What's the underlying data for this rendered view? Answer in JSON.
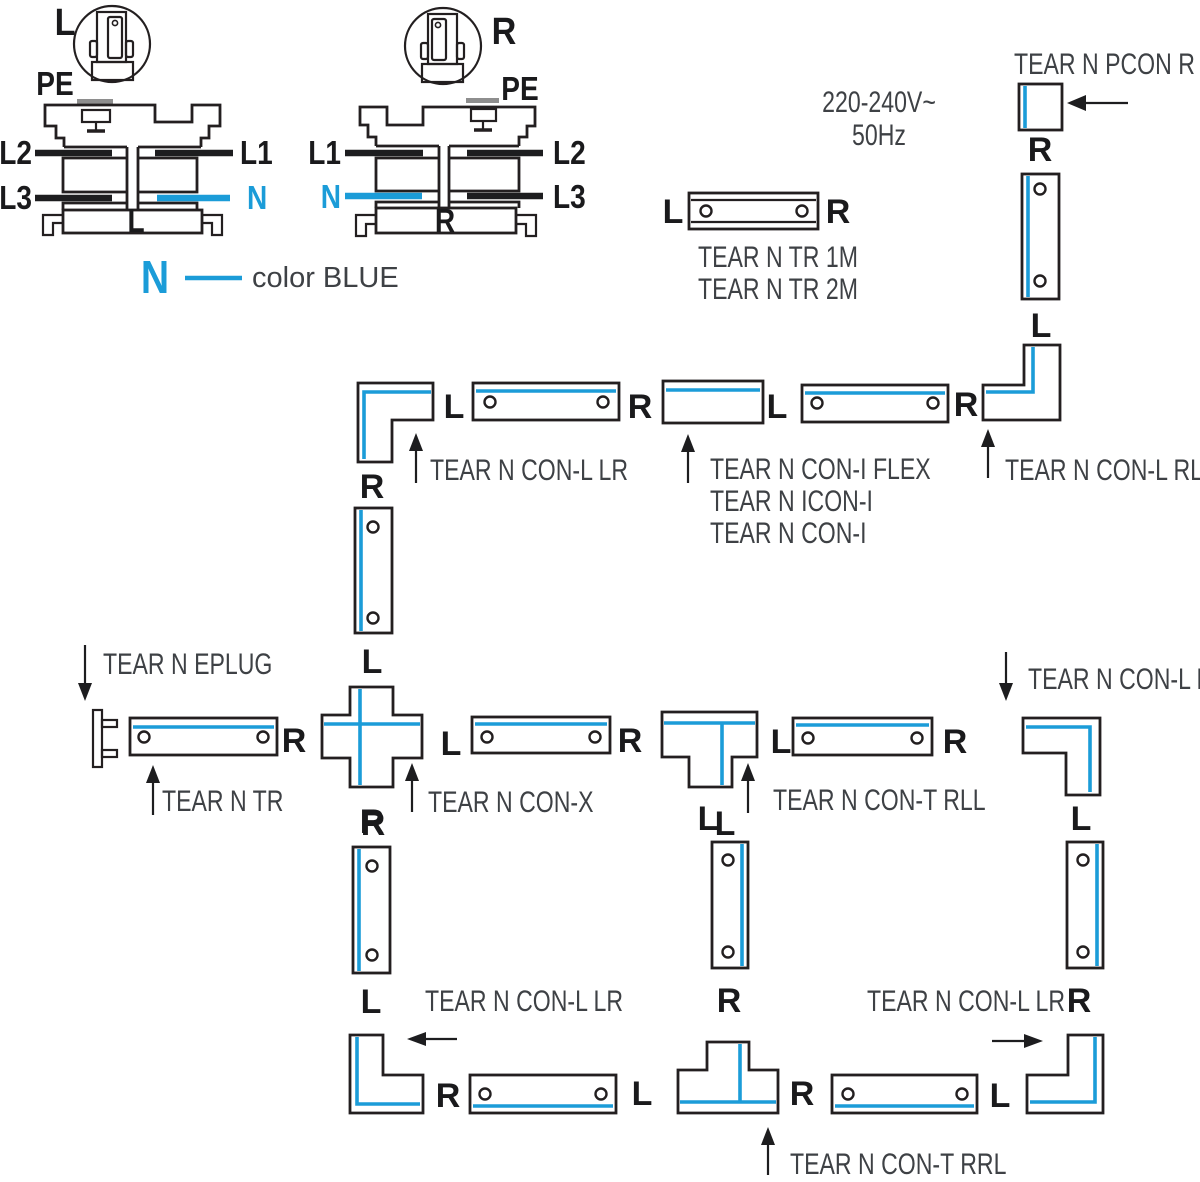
{
  "colors": {
    "blue": "#1B9CD8",
    "outline": "#231F20",
    "text": "#3E4145"
  },
  "cross_section_left": {
    "plug": "L",
    "pe": "PE",
    "top_left": "L2",
    "top_right": "L1",
    "bottom_left": "L3",
    "bottom_right": "N",
    "base": "L"
  },
  "cross_section_right": {
    "plug": "R",
    "pe": "PE",
    "top_left": "L1",
    "top_right": "L2",
    "bottom_left": "N",
    "bottom_right": "L3",
    "base": "R"
  },
  "legend": {
    "symbol": "N",
    "label": "color BLUE"
  },
  "power": {
    "voltage": "220-240V~",
    "frequency": "50Hz"
  },
  "products": {
    "pcon": "TEAR N PCON R",
    "tr_1m": "TEAR N TR 1M",
    "tr_2m": "TEAR N TR 2M",
    "con_l_lr_top": "TEAR N CON-L LR",
    "con_i_flex": "TEAR N CON-I FLEX",
    "icon_i": "TEAR N ICON-I",
    "con_i": "TEAR N CON-I",
    "con_l_rl": "TEAR N CON-L RL",
    "eplug": "TEAR N EPLUG",
    "con_l_lr_mid": "TEAR N CON-L LR",
    "tr": "TEAR N TR",
    "con_x": "TEAR N CON-X",
    "con_t_rll": "TEAR N CON-T RLL",
    "con_l_lr_bottom_left": "TEAR N CON-L LR",
    "con_l_lr_bottom_right": "TEAR N CON-L LR",
    "con_t_rrl": "TEAR N CON-T RRL"
  },
  "ports": {
    "tr_left": "L",
    "tr_right": "R",
    "pcon_out": "R",
    "feed_track_bottom": "L",
    "corner_tl_right": "L",
    "row1_track1_right": "R",
    "con_i_right": "L",
    "row1_track2_right": "R",
    "corner_tl_bottom": "R",
    "cross_top": "L",
    "cross_right": "L",
    "cross_bottom": "R",
    "eplug_track_right": "R",
    "row2_track1_right": "R",
    "t_rll_bottom": "L",
    "row2_track2_left": "L",
    "row2_track2_right": "R",
    "corner_mr_bottom": "L",
    "vleft_top": "R",
    "vleft_bottom": "L",
    "vmid_top": "L",
    "vmid_bottom": "R",
    "vright_bottom": "R",
    "corner_bl_right": "R",
    "row3_track1_right": "L",
    "t_rrl_right": "R",
    "row3_track2_right": "L"
  }
}
